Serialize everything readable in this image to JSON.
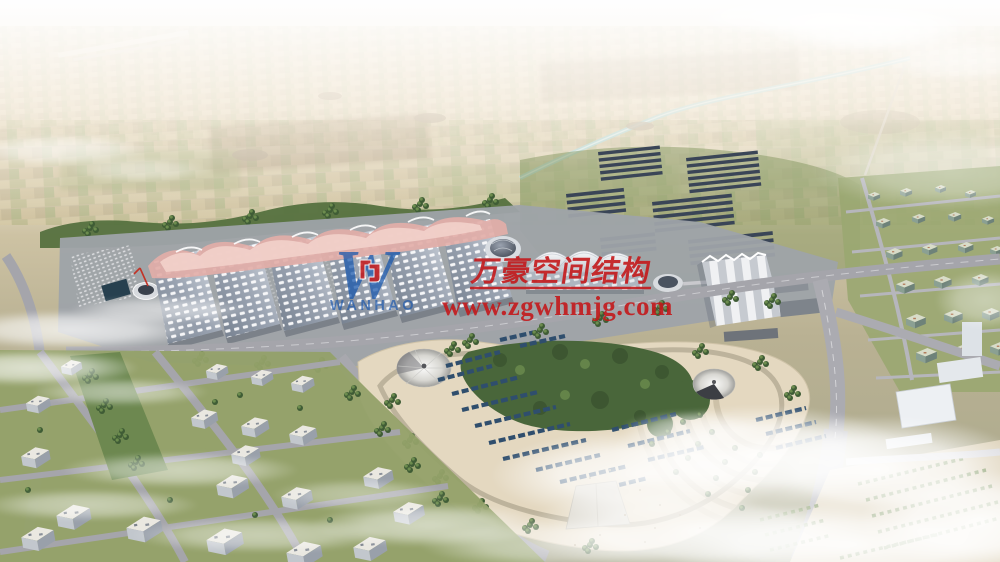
{
  "watermark": {
    "logo_letter": "W",
    "logo_wordmark": "WANHAO",
    "company_name_cn": "万豪空间结构",
    "website": "www.zgwhmjg.com",
    "text_color": "#c4191b",
    "logo_color": "#1a57ad"
  },
  "scene_palette": {
    "sky_haze": "#eef0ee",
    "farmland": "#cfc3a4",
    "canal": "#9fd2d6",
    "hall_roof_grid": "#f6f7f9",
    "roof_ridge_pink": "#e2aea8",
    "park_sand": "#e4d8c0",
    "solar_panel": "#3a4557",
    "vegetation": "#49663a",
    "road": "#a5a5ab"
  }
}
